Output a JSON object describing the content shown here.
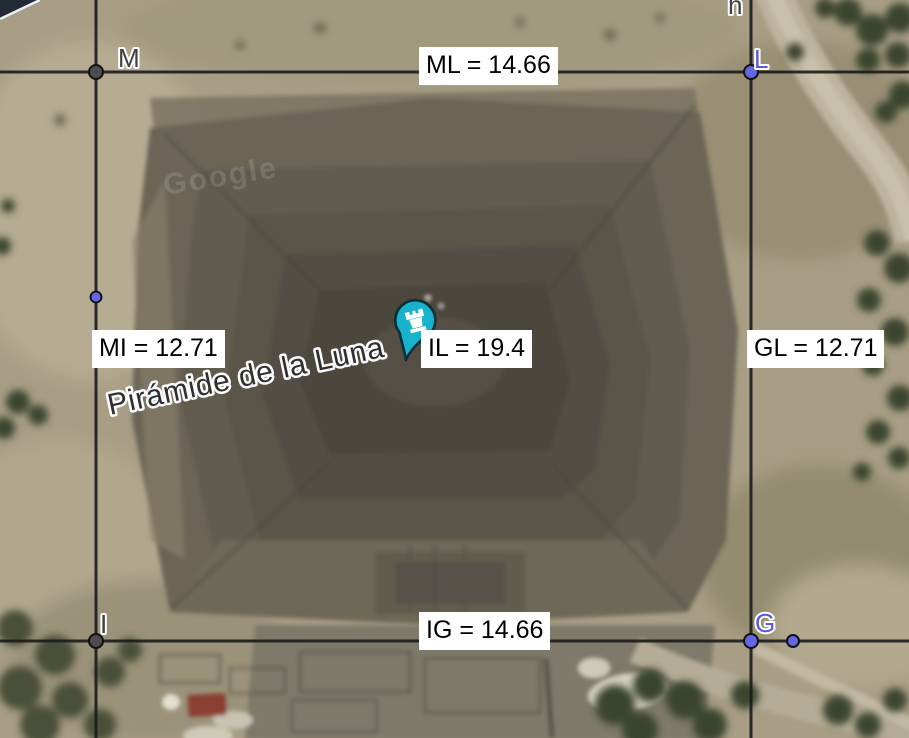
{
  "map": {
    "place_label": "Pirámide de la Luna",
    "watermark": "Google",
    "marker_color": "#17b3cd"
  },
  "overlay": {
    "points": {
      "M": "M",
      "L": "L",
      "I": "I",
      "G": "G"
    },
    "line_label": "h",
    "measurements": {
      "ML": "ML = 14.66",
      "MI": "MI = 12.71",
      "IL": "IL = 19.4",
      "GL": "GL = 12.71",
      "IG": "IG = 14.66"
    },
    "colors": {
      "line": "#1b1b1b",
      "point_blue": "#6466e3",
      "point_gray": "#4d4d4d",
      "label_blue": "#5858de",
      "label_gray": "#3f3f3f",
      "measurement_bg": "#ffffff",
      "measurement_text": "#000000"
    }
  }
}
